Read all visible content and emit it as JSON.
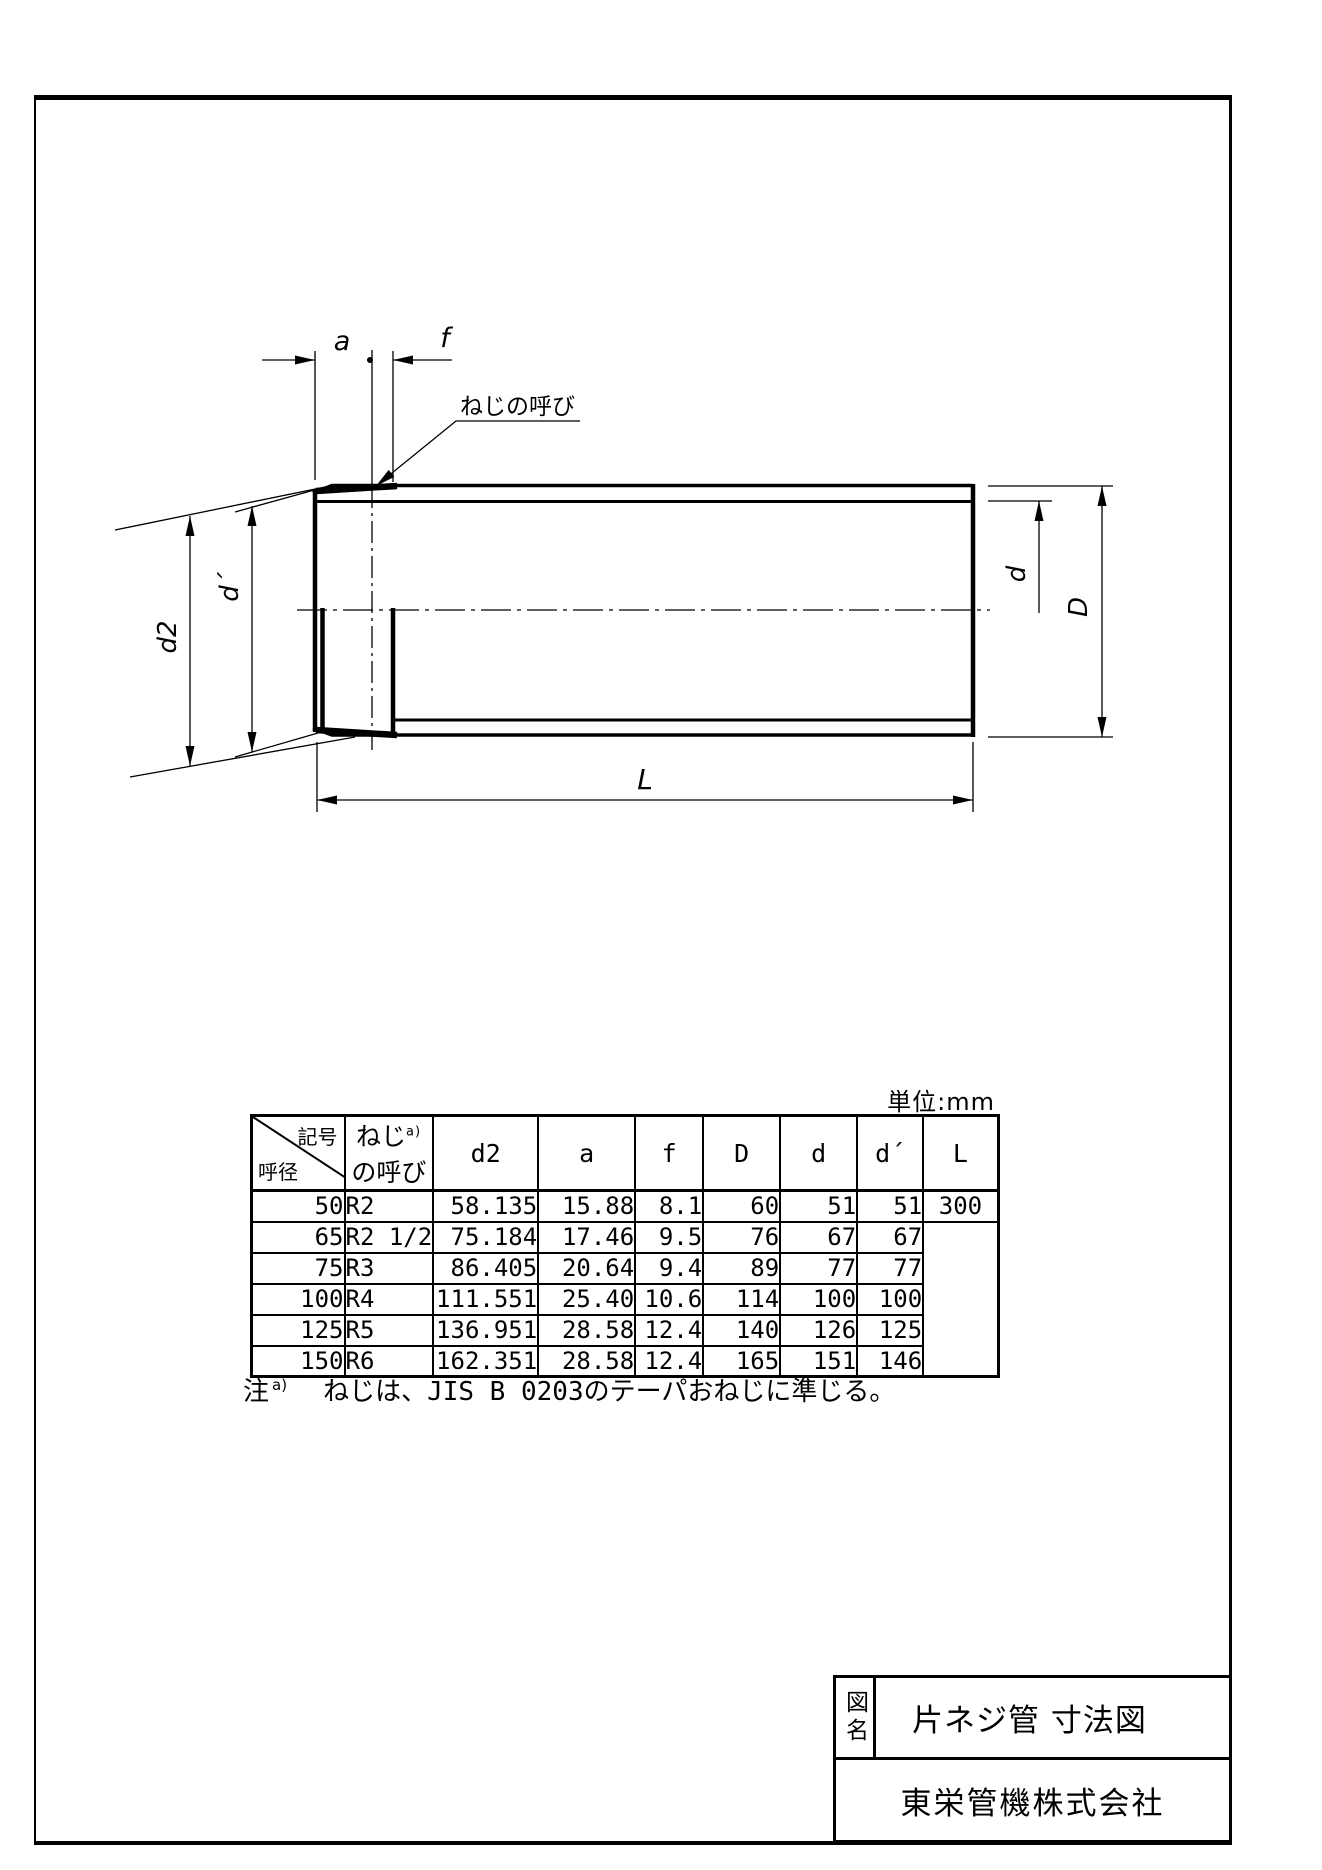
{
  "drawing": {
    "labels": {
      "a": "a",
      "f": "f",
      "leader": "ねじの呼び",
      "d2": "d2",
      "d_prime": "d´",
      "d": "d",
      "D": "D",
      "L": "L"
    }
  },
  "table": {
    "unit": "単位:mm",
    "corner": {
      "top": "記号",
      "bottom": "呼径"
    },
    "thread_header": {
      "line1": "ねじ",
      "sup": "a)",
      "line2": "の呼び"
    },
    "columns": [
      "d2",
      "a",
      "f",
      "D",
      "d",
      "d´",
      "L"
    ],
    "rows": [
      [
        "50",
        "R2",
        "58.135",
        "15.88",
        "8.1",
        "60",
        "51",
        "51",
        "300"
      ],
      [
        "65",
        "R2 1/2",
        "75.184",
        "17.46",
        "9.5",
        "76",
        "67",
        "67",
        ""
      ],
      [
        "75",
        "R3",
        "86.405",
        "20.64",
        "9.4",
        "89",
        "77",
        "77",
        ""
      ],
      [
        "100",
        "R4",
        "111.551",
        "25.40",
        "10.6",
        "114",
        "100",
        "100",
        ""
      ],
      [
        "125",
        "R5",
        "136.951",
        "28.58",
        "12.4",
        "140",
        "126",
        "125",
        ""
      ],
      [
        "150",
        "R6",
        "162.351",
        "28.58",
        "12.4",
        "165",
        "151",
        "146",
        ""
      ]
    ]
  },
  "note": {
    "prefix": "注",
    "sup": "a)",
    "body": "ねじは、JIS B 0203のテーパおねじに準じる。"
  },
  "title_block": {
    "label": "図名",
    "title": "片ネジ管 寸法図",
    "company": "東栄管機株式会社"
  }
}
